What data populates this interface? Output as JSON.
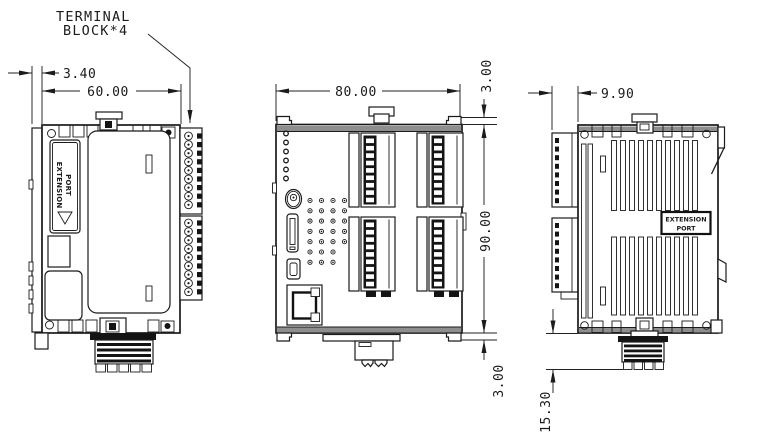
{
  "callout": {
    "line1": "TERMINAL",
    "line2": "BLOCK*4"
  },
  "views": {
    "left": {
      "dims": {
        "offset": "3.40",
        "width": "60.00"
      },
      "extension_port": {
        "line1": "EXTENSION",
        "line2": "PORT"
      }
    },
    "front": {
      "dims": {
        "width": "80.00",
        "tab_top": "3.00",
        "height": "90.00",
        "tab_bottom": "3.00"
      }
    },
    "right": {
      "dims": {
        "terminal_depth": "9.90",
        "clip_height": "15.30"
      },
      "extension_port": {
        "line1": "EXTENSION",
        "line2": "PORT"
      }
    }
  },
  "colors": {
    "line": "#1b1b1b",
    "background": "#ffffff",
    "shade_band": "#8e8e8e",
    "fill_dark": "#141414"
  }
}
